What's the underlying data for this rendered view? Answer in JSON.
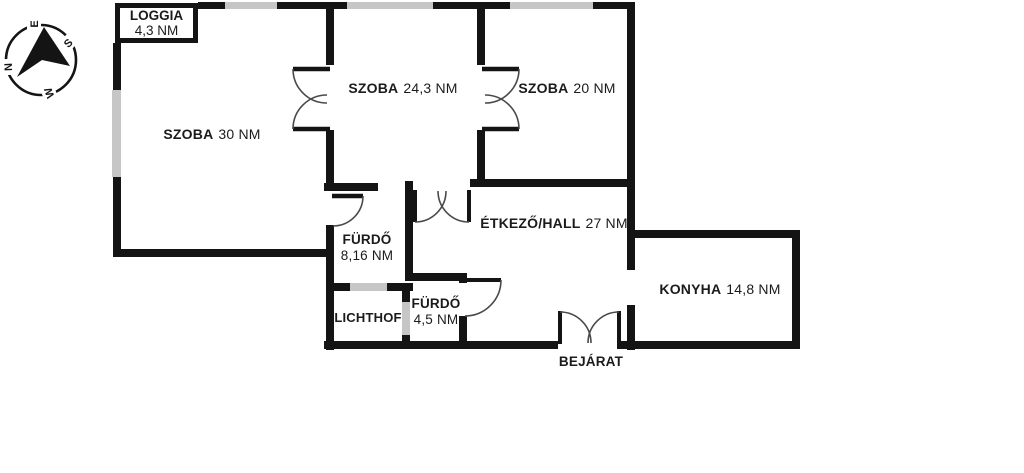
{
  "compass": {
    "n": "N",
    "e": "E",
    "s": "S",
    "w": "W"
  },
  "rooms": {
    "loggia": {
      "name": "LOGGIA",
      "area": "4,3 NM"
    },
    "szoba_30": {
      "name": "SZOBA",
      "area": "30 NM"
    },
    "szoba_24": {
      "name": "SZOBA",
      "area": "24,3 NM"
    },
    "szoba_20": {
      "name": "SZOBA",
      "area": "20 NM"
    },
    "furdo_8": {
      "name": "FÜRDŐ",
      "area": "8,16 NM"
    },
    "etkezo": {
      "name": "ÉTKEZŐ/HALL",
      "area": "27 NM"
    },
    "furdo_4": {
      "name": "FÜRDŐ",
      "area": "4,5 NM"
    },
    "lichthof": {
      "name": "LICHTHOF"
    },
    "konyha": {
      "name": "KONYHA",
      "area": "14,8 NM"
    },
    "bejarat": {
      "name": "BEJÁRAT"
    }
  },
  "colors": {
    "wall": "#141414",
    "window": "#c6c6c6",
    "door_arc": "#4a4a4a",
    "text": "#1b1b1b",
    "background": "#ffffff"
  }
}
